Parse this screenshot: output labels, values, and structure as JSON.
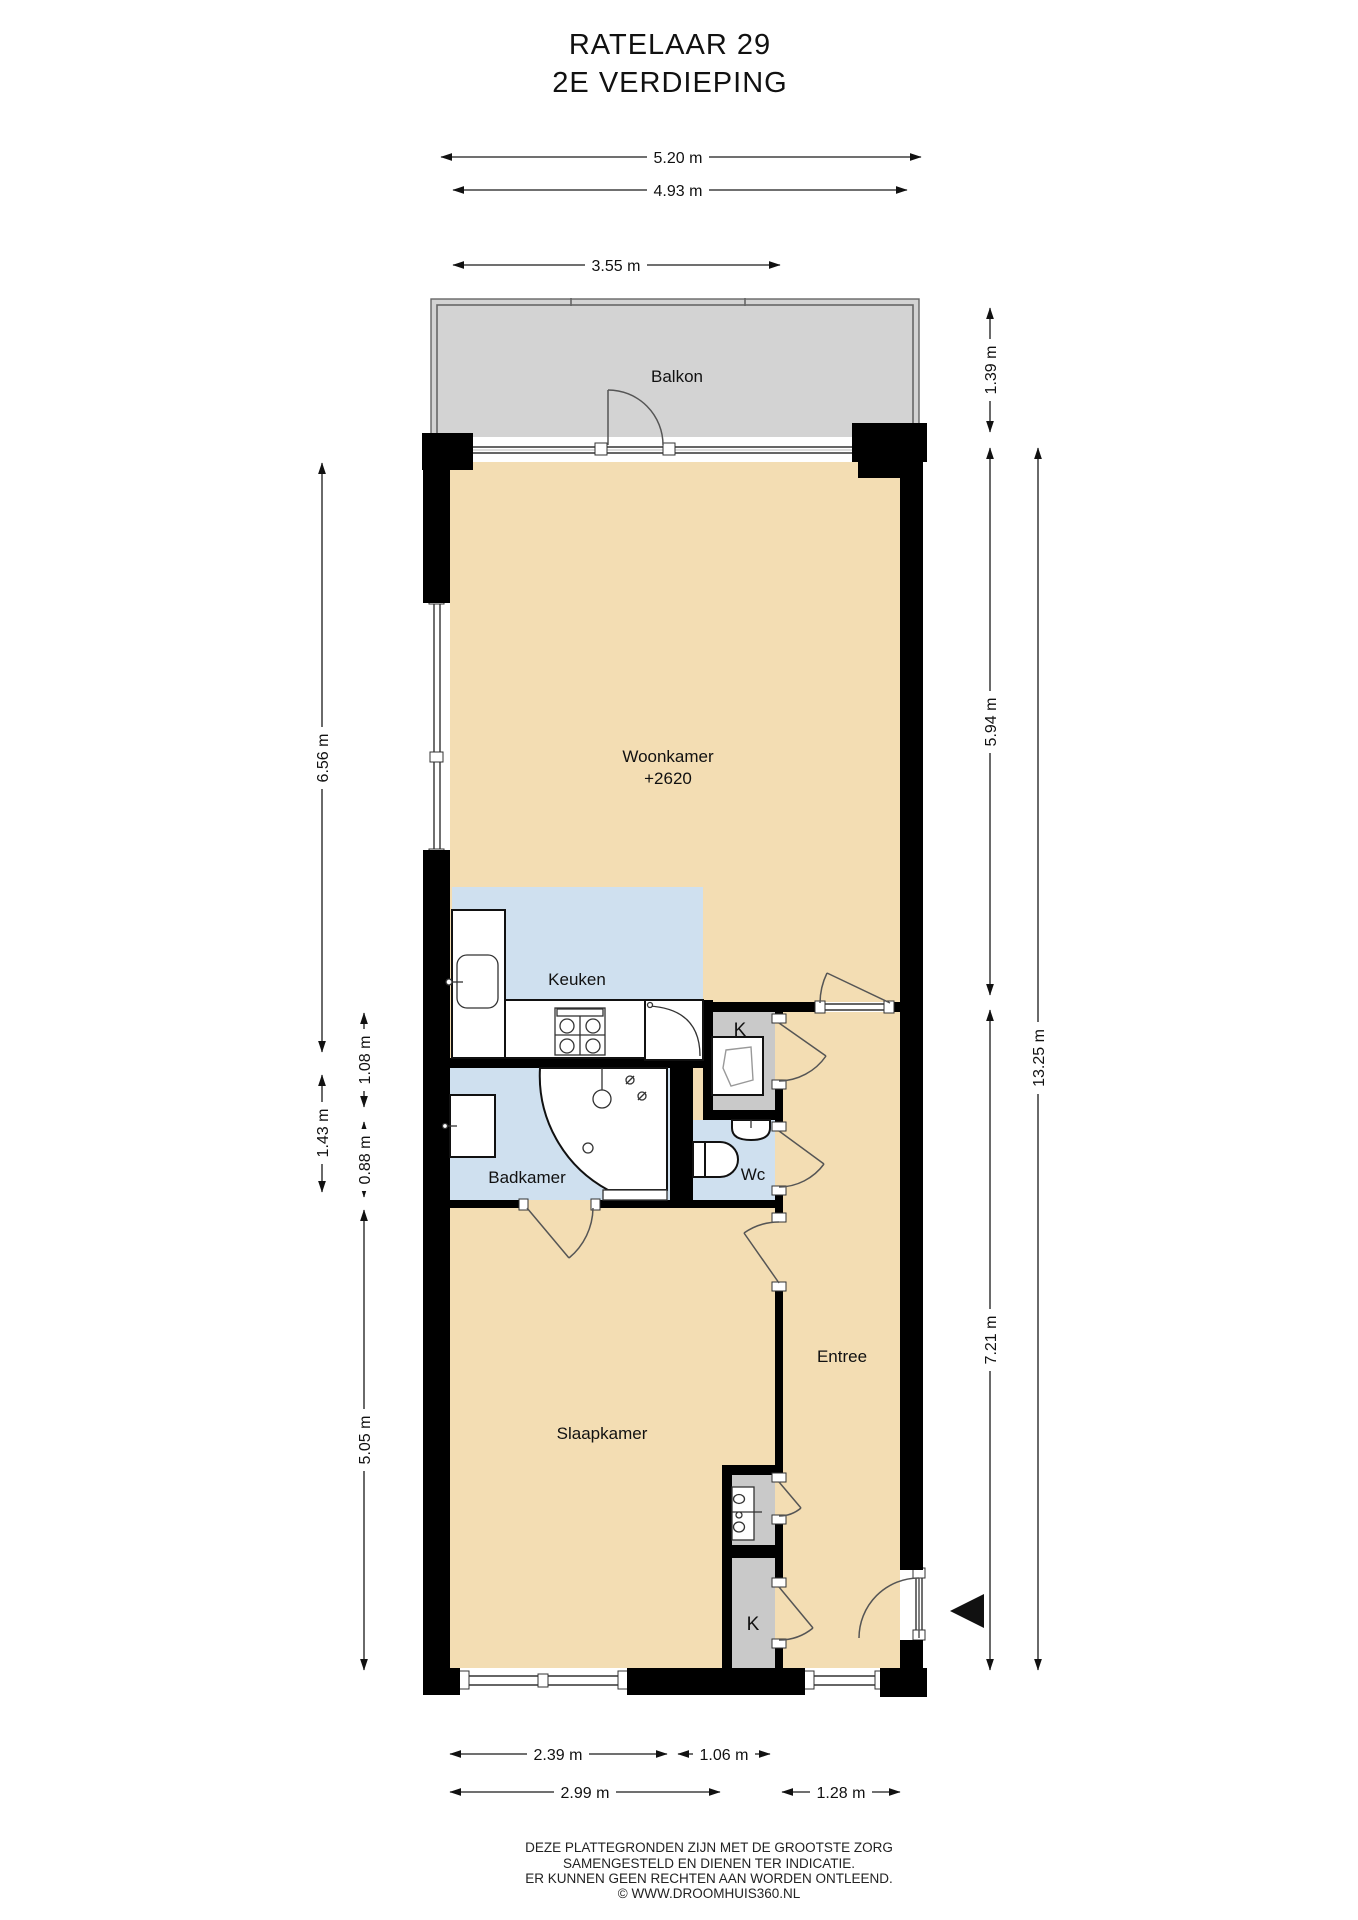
{
  "title": {
    "line1": "RATELAAR 29",
    "line2": "2E VERDIEPING"
  },
  "rooms": {
    "balkon": "Balkon",
    "woonkamer": "Woonkamer",
    "woonkamer_level": "+2620",
    "keuken": "Keuken",
    "badkamer": "Badkamer",
    "wc": "Wc",
    "entree": "Entree",
    "slaapkamer": "Slaapkamer",
    "closet_top": "K",
    "closet_bottom": "K"
  },
  "dimensions": {
    "top_1": "5.20 m",
    "top_2": "4.93 m",
    "top_3": "3.55 m",
    "left_1": "6.56 m",
    "left_2": "1.43 m",
    "left_3": "1.08 m",
    "left_4": "0.88 m",
    "left_5": "5.05 m",
    "right_1": "1.39 m",
    "right_2": "5.94 m",
    "right_3": "13.25 m",
    "right_4": "7.21 m",
    "bottom_1": "2.39 m",
    "bottom_2": "1.06 m",
    "bottom_3": "2.99 m",
    "bottom_4": "1.28 m"
  },
  "footer": {
    "line1": "DEZE PLATTEGRONDEN ZIJN MET DE GROOTSTE ZORG",
    "line2": "SAMENGESTELD EN DIENEN TER INDICATIE.",
    "line3": "ER KUNNEN GEEN RECHTEN AAN WORDEN ONTLEEND.",
    "line4": "© WWW.DROOMHUIS360.NL"
  },
  "colors": {
    "floor": "#f3ddb3",
    "wet_room": "#cfe0ef",
    "balcony": "#d3d3d3",
    "closet": "#c9c9c9",
    "wall": "#000000",
    "line": "#1a1a1a"
  }
}
